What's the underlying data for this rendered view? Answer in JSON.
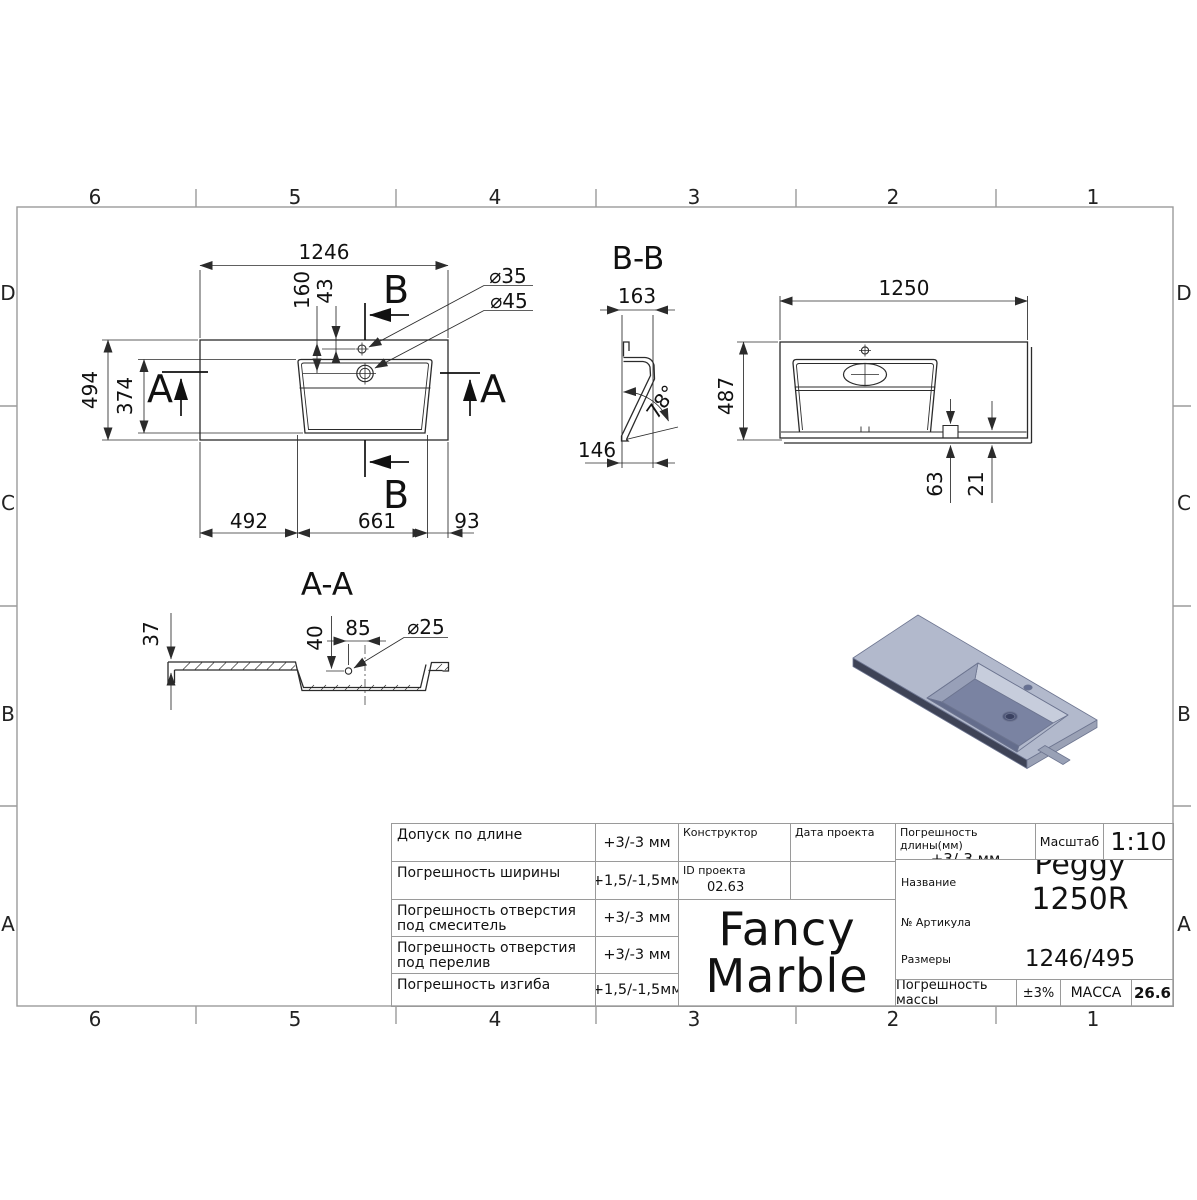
{
  "grid": {
    "columns": [
      "6",
      "5",
      "4",
      "3",
      "2",
      "1"
    ],
    "rows": [
      "D",
      "C",
      "B",
      "A"
    ]
  },
  "top_view": {
    "dim_width": "1246",
    "dim_overflow_offset": "160",
    "dim_faucet_offset": "43",
    "faucet_dia": "⌀35",
    "overflow_dia": "⌀45",
    "dim_depth": "494",
    "dim_basin_depth": "374",
    "dim_left": "492",
    "dim_basin": "661",
    "dim_right": "93",
    "section_a": "A",
    "section_b": "B"
  },
  "section_bb": {
    "title": "B-B",
    "dim_top": "163",
    "dim_angle": "78°",
    "dim_bottom": "146"
  },
  "front_view": {
    "dim_width": "1250",
    "dim_height": "487",
    "dim_notch": "63",
    "dim_wall": "21"
  },
  "section_aa": {
    "title": "A-A",
    "dim_thickness": "37",
    "dim_hole_depth": "40",
    "dim_hole_offset": "85",
    "hole_dia": "⌀25"
  },
  "iso_view": {
    "top_color": "#b2b9cc",
    "edge_color": "#3e4356",
    "side_color": "#9aa1b5",
    "far_wall_color": "#c7cddc",
    "ramp_color": "#98a0b8",
    "floor_color": "#7a83a2",
    "near_wall_color": "#646d8c"
  },
  "title_block": {
    "tolerances": [
      {
        "label": "Допуск по длине",
        "value": "+3/-3 мм"
      },
      {
        "label": "Погрешность ширины",
        "value": "+1,5/-1,5мм"
      },
      {
        "label": "Погрешность отверстия под смеситель",
        "value": "+3/-3 мм"
      },
      {
        "label": "Погрешность отверстия под перелив",
        "value": "+3/-3 мм"
      },
      {
        "label": "Погрешность изгиба",
        "value": "+1,5/-1,5мм"
      }
    ],
    "constructor_label": "Конструктор",
    "project_date_label": "Дата проекта",
    "project_id_label": "ID проекта",
    "project_id_value": "02.63",
    "logo_line1": "Fancy",
    "logo_line2": "Marble",
    "length_tolerance_label": "Погрешность длины(мм)",
    "length_tolerance_value": "+3/-3 мм",
    "scale_label": "Масштаб",
    "scale_value": "1:10",
    "name_label": "Название",
    "name_value": "Peggy 1250R",
    "article_label": "№ Артикула",
    "dimensions_label": "Размеры",
    "dimensions_value": "1246/495",
    "mass_tolerance_label": "Погрешность массы",
    "mass_tolerance_value": "±3%",
    "mass_label": "МАССА",
    "mass_value": "26.6"
  }
}
